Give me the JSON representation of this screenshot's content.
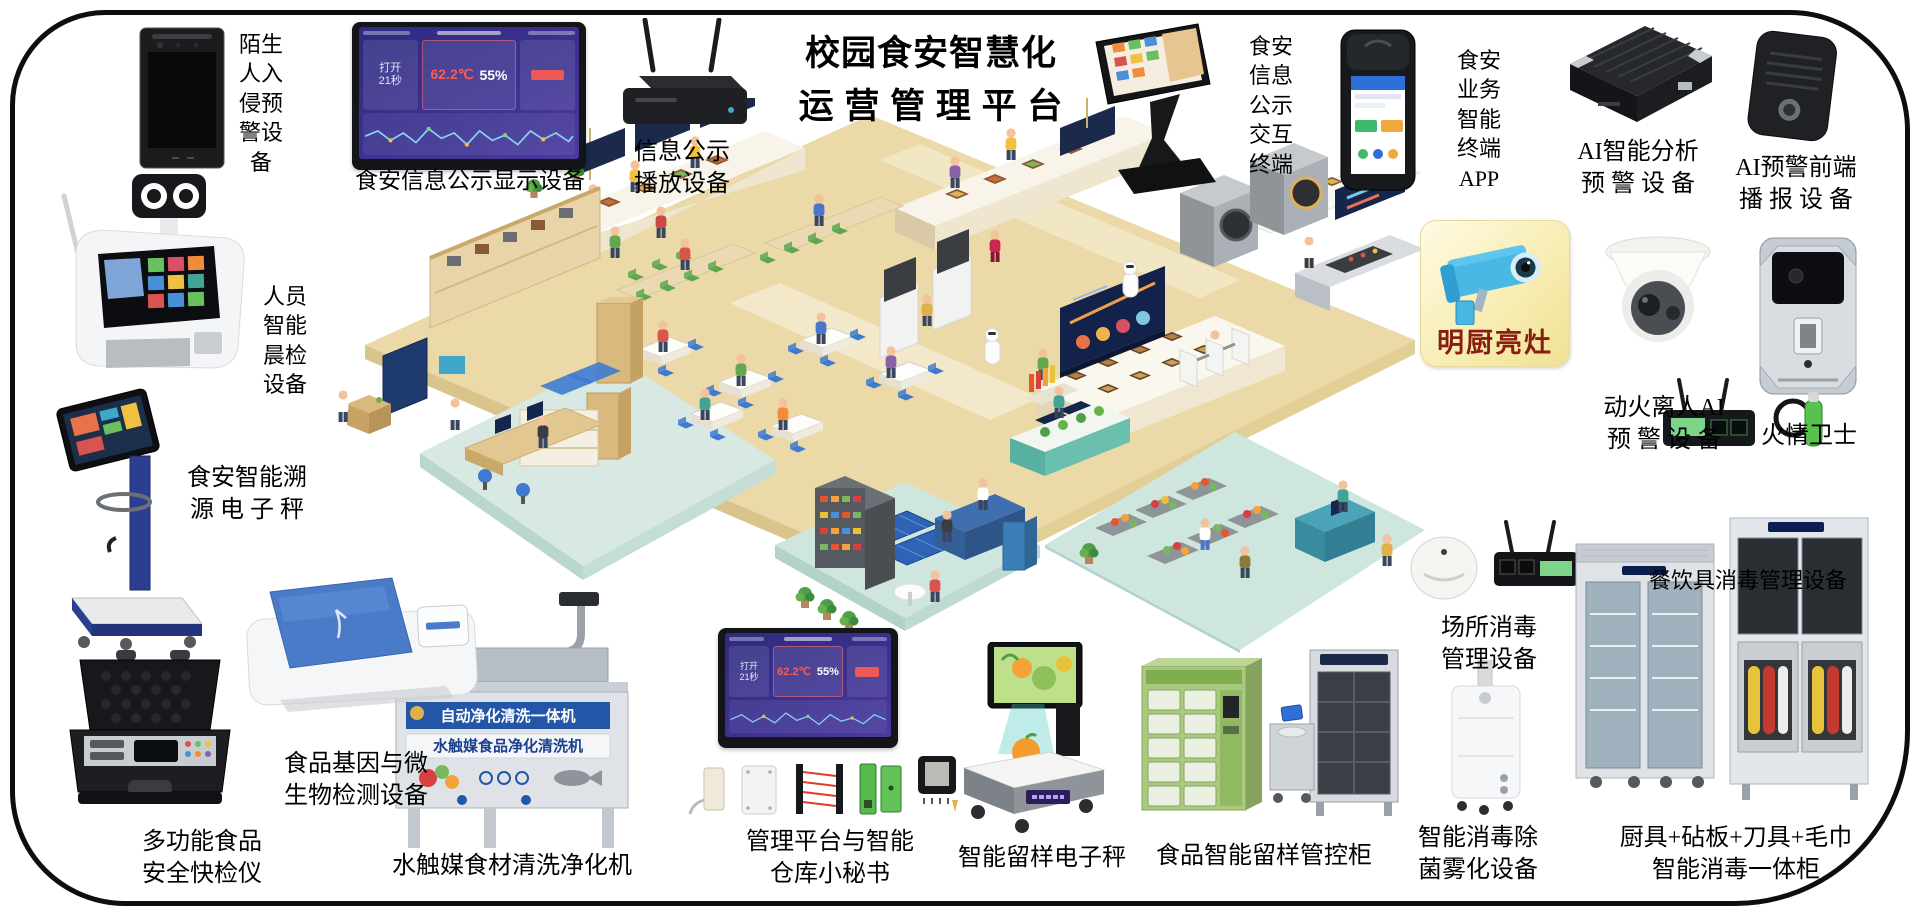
{
  "page": {
    "title": "校园食安智慧化\n运 营 管 理 平 台"
  },
  "labels": {
    "face_intrusion": "陌生\n人入\n侵预\n警设\n备",
    "info_display": "食安信息公示显示设备",
    "info_player": "信息公示\n播放设备",
    "interactive_terminal": "食安\n信息\n公示\n交互\n终端",
    "app_terminal": "食安\n业务\n智能\n终端\nAPP",
    "ai_analysis": "AI智能分析\n预 警 设 备",
    "ai_broadcast": "AI预警前端\n播 报 设 备",
    "mingchu": "明厨亮灶",
    "fire_ai": "动火离人AI\n预 警 设 备",
    "fire_guard": "火情卫士",
    "tableware_disinfect": "餐饮具消毒管理设备",
    "place_disinfect": "场所消毒\n管理设备",
    "fog_device": "智能消毒除\n菌雾化设备",
    "combo_cabinet": "厨具+砧板+刀具+毛巾\n智能消毒一体柜",
    "sample_cabinet": "食品智能留样管控柜",
    "sample_scale": "智能留样电子秤",
    "mgmt_platform": "管理平台与智能\n仓库小秘书",
    "washer": "水触媒食材清洗净化机",
    "gene_detector": "食品基因与微\n生物检测设备",
    "rapid_tester": "多功能食品\n安全快检仪",
    "trace_scale": "食安智能溯\n源 电 子 秤",
    "morning_check": "人员\n智能\n晨检\n设备"
  },
  "dashboard": {
    "door_label": "打开",
    "door_value": "21秒",
    "temperature": "62.2℃",
    "humidity": "55%"
  },
  "washer_banners": {
    "line1": "自动净化清洗一体机",
    "line2": "水触媒食品净化清洗机"
  },
  "colors": {
    "accent_navy": "#16264d",
    "floor_tan": "#ecd9a8",
    "platform_teal": "#d2e7e0",
    "alert_red": "#ff5a4e",
    "brand_yellow": "#f5e9a8"
  }
}
